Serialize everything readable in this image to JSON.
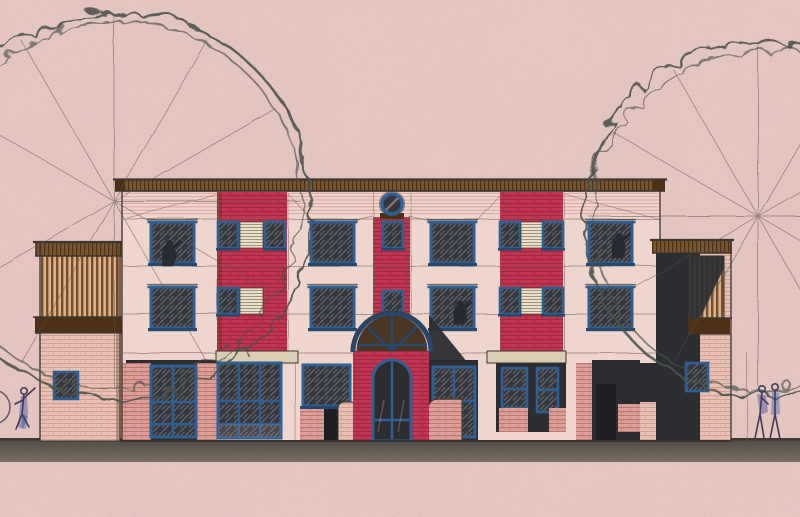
{
  "scene": {
    "medium": "hand-drawn architectural elevation, coloured pencil and ink on pink paper",
    "view": "front elevation of a three-storey building with ground-floor shopfronts, two scribbled trees and three sketched pedestrians",
    "elements": {
      "trees": "two scribbled-outline tree canopies with straight radiating branch lines, one at the left and one at the right",
      "building_core": "three-storey pink facade with a brown cornice, two vertical red-brick window strips and a central red-brick entrance tower",
      "central_tower": "round blue-ringed window above small square windows and a semicircular brown fanlight over the arched entrance",
      "wings": "lower side wings with brown slatted balcony screens, the right one deeply shadowed",
      "ground": "dark speckled ground strip across the full width of the sheet",
      "people": "one sketched walking figure with a wheel at the lower left, two sketched standing figures at the lower right"
    },
    "counts": {
      "storeys": 3,
      "large_upper_windows": 8,
      "small_strip_windows": 9,
      "louvre_panels": 4,
      "round_windows": 1,
      "entrance_arches": 1,
      "balconies": 2,
      "trees": 2,
      "figures": 3
    }
  },
  "palette": {
    "paper": "#e8cac4",
    "facade": "#eed6ce",
    "frieze_line": "#c97a72",
    "brick_red": "#c23550",
    "brick_red_line": "#8a2039",
    "brick_pink": "#e9c1b4",
    "brick_pink_line": "#c18e80",
    "brick_salmon": "#dda099",
    "brick_salmon_line": "#aa6158",
    "frame_blue": "#2f5f93",
    "frame_blue_dark": "#27486d",
    "glazing": "#34373d",
    "glazing_line": "#5d626b",
    "glazing_lite": "#e4bab4",
    "brown": "#7a5530",
    "brown_dark": "#4c3115",
    "fan_brown": "#4a3625",
    "slat_bg": "#d7b28f",
    "slat": "#7b4e28",
    "louver": "#eae1cd",
    "louver_line": "#a3937a",
    "stone": "#dacdb4",
    "dark_mass": "#2b2d31",
    "dark_deep": "#1d1f23",
    "ground_top": "#4a443d",
    "ground_light": "#80766b",
    "outline": "#3c352f",
    "sketch": "#7d5c55",
    "tree_line": "#4b514b",
    "spoke": "#56524b",
    "figure_ink": "#403c58",
    "figure_purple": "#5f55a5",
    "figure_blue": "#3f64ab",
    "silhouette": "#23262c"
  }
}
